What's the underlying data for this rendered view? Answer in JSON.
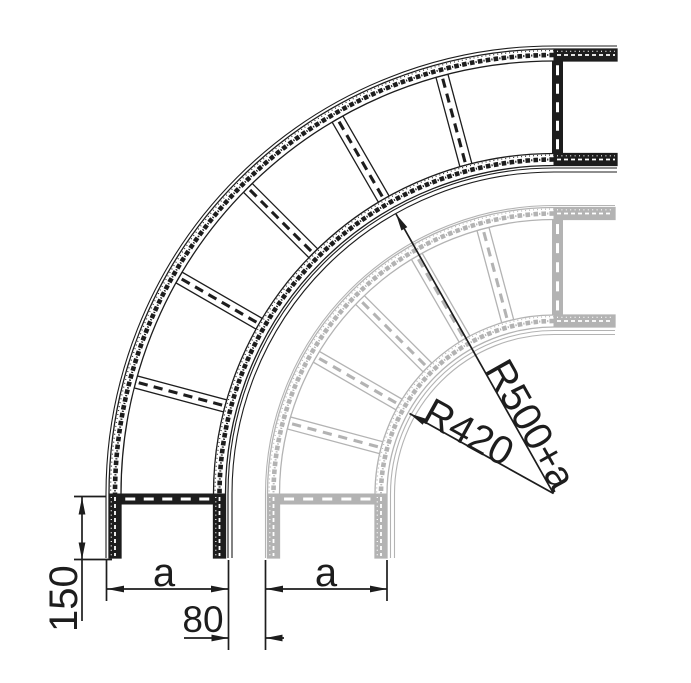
{
  "colors": {
    "background": "#ffffff",
    "primary": "#1d1d1d",
    "ghost": "#b3b3b3",
    "white": "#ffffff"
  },
  "labels": {
    "straight_length": "150",
    "width_main": "a",
    "width_ghost": "a",
    "offset_gap": "80",
    "radius_main": "R500+a",
    "radius_ghost": "R420"
  },
  "geometry": {
    "center": {
      "x": 554,
      "y": 494
    },
    "bottom_end_y": 558,
    "rung_angles_deg": [
      15,
      30,
      45,
      60,
      75
    ],
    "main_ladder": {
      "top_end_x": 617,
      "outer_contour_r": 448,
      "outer_band": {
        "lo": 433,
        "hi": 445
      },
      "inner_band": {
        "lo": 328.5,
        "hi": 340.5
      },
      "inner_contours": [
        326,
        322
      ],
      "rung_span": {
        "lo": 340.5,
        "hi": 433
      }
    },
    "ghost_ladder": {
      "top_end_x": 615,
      "outer_contour_r": 288.5,
      "outer_band": {
        "lo": 274.5,
        "hi": 286.5
      },
      "inner_band": {
        "lo": 167,
        "hi": 179
      },
      "inner_contours": [
        163.5,
        159.5
      ],
      "rung_span": {
        "lo": 179,
        "hi": 274.5
      }
    }
  }
}
